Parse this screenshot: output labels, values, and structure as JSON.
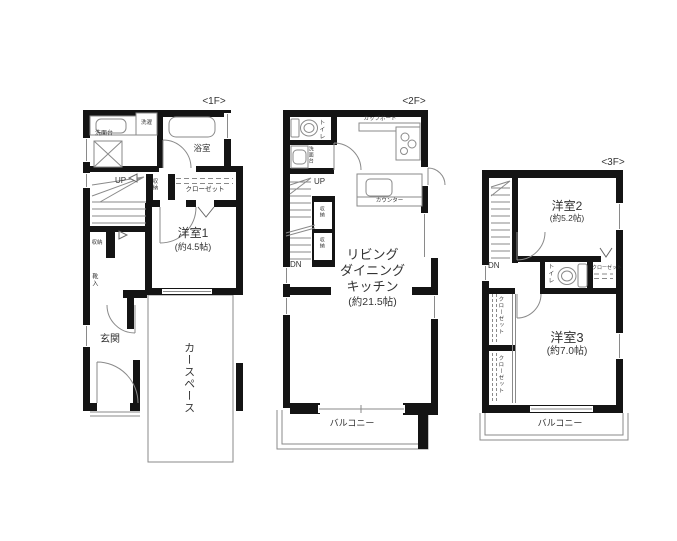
{
  "colors": {
    "wall": "#141414",
    "line": "#8a8a8a",
    "text": "#333333",
    "bg": "#ffffff"
  },
  "f1": {
    "title": "<1F>",
    "labels": {
      "washstand": "洗面台",
      "laundry": "洗濯",
      "bath": "浴室",
      "up": "UP",
      "storage_closet": "収納",
      "closet": "クローゼット",
      "room": "洋室1",
      "room_size": "(約4.5帖)",
      "storage": "収納",
      "shoes": "靴入",
      "entrance": "玄関",
      "car_space": "カースペース"
    }
  },
  "f2": {
    "title": "<2F>",
    "labels": {
      "toilet": "トイレ",
      "washstand": "洗面台",
      "cupboard": "カップボード",
      "up": "UP",
      "dn": "DN",
      "storage_top": "収納",
      "storage_bottom": "収納",
      "counter": "カウンター",
      "ldk_line1": "リビング",
      "ldk_line2": "ダイニング",
      "ldk_line3": "キッチン",
      "ldk_size": "(約21.5帖)",
      "balcony": "バルコニー"
    }
  },
  "f3": {
    "title": "<3F>",
    "labels": {
      "room2": "洋室2",
      "room2_size": "(約5.2帖)",
      "dn": "DN",
      "toilet": "トイレ",
      "closet_right": "クローゼット",
      "closet_left_top": "クローゼット",
      "closet_left_bottom": "クローゼット",
      "room3": "洋室3",
      "room3_size": "(約7.0帖)",
      "balcony": "バルコニー"
    }
  }
}
